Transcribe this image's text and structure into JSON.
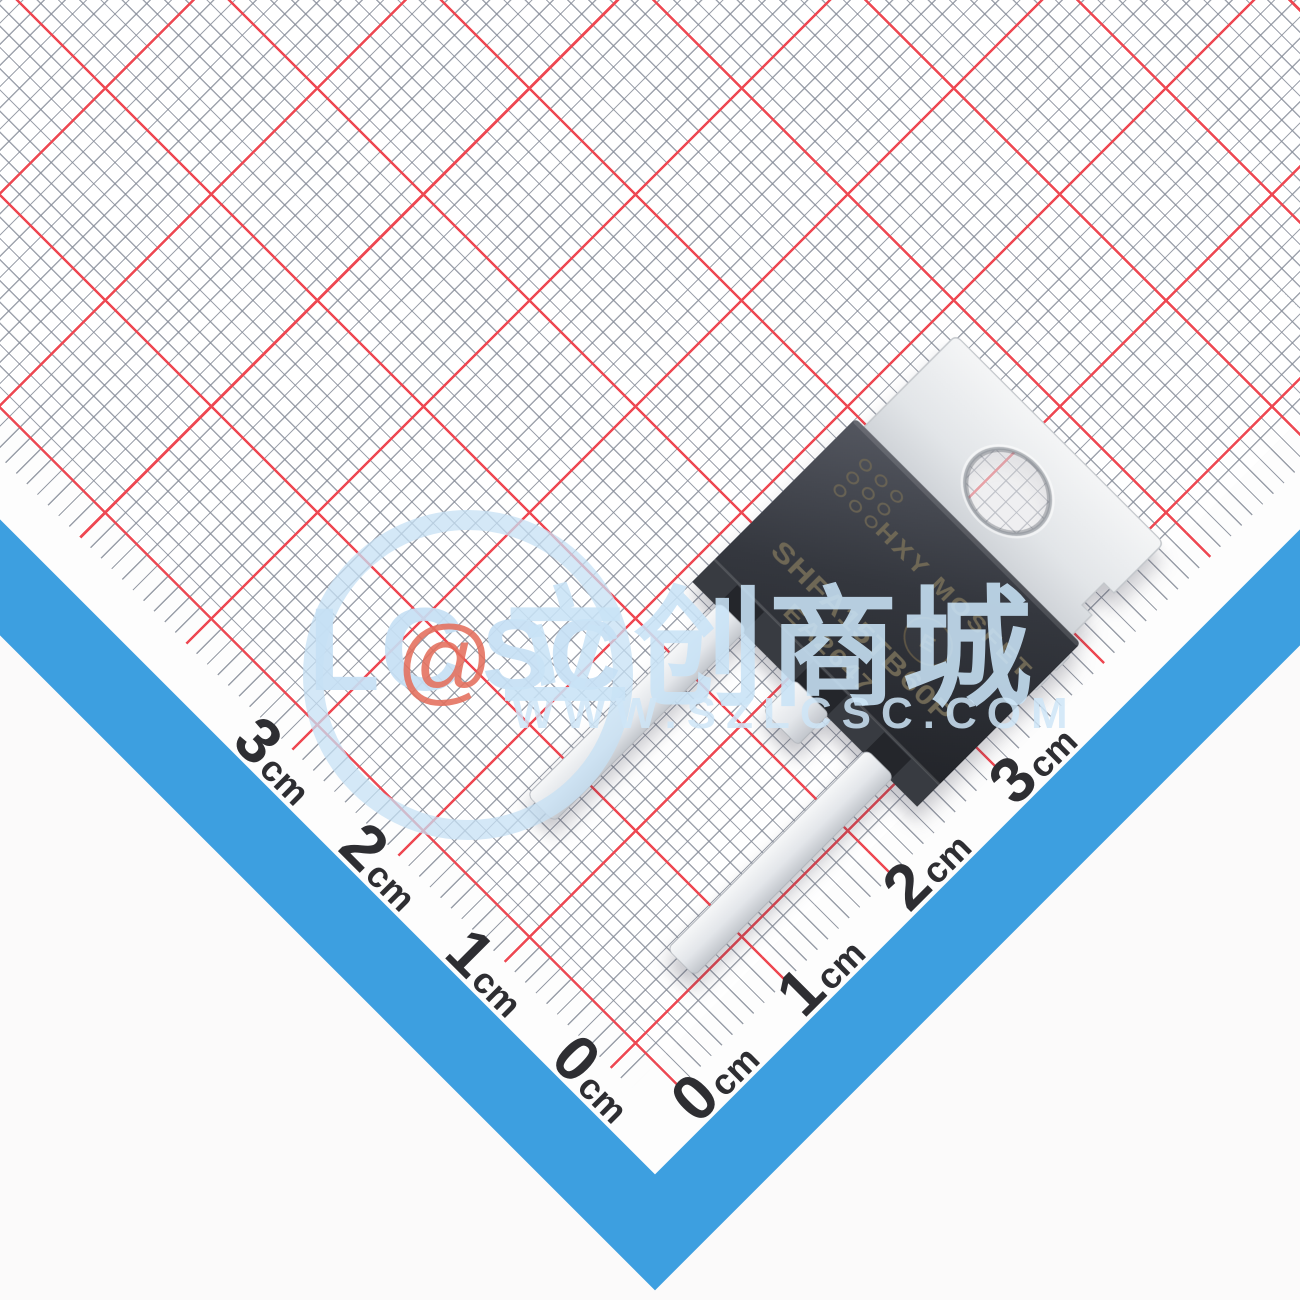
{
  "component": {
    "marking_line1": "HXY MOSFET",
    "marking_line2": "SHFA15TB60P",
    "marking_line3": "EA2647",
    "mold_mark": "E"
  },
  "watermark": {
    "logo_left": "LC",
    "logo_at": "@",
    "logo_right": "SC",
    "brand_cn": "立创商城",
    "url": "WWW.SZLCSC.COM"
  },
  "ruler": {
    "left_labels": [
      {
        "n": "3",
        "u": "cm"
      },
      {
        "n": "2",
        "u": "cm"
      },
      {
        "n": "1",
        "u": "cm"
      },
      {
        "n": "0",
        "u": "cm"
      }
    ],
    "right_labels": [
      {
        "n": "0",
        "u": "cm"
      },
      {
        "n": "1",
        "u": "cm"
      },
      {
        "n": "2",
        "u": "cm"
      },
      {
        "n": "3",
        "u": "cm"
      }
    ]
  },
  "colors": {
    "grid_red": "#ee4852",
    "grid_gray": "#9298a4",
    "border_blue": "#3d9fe0",
    "watermark_blue": "#c8e0f4",
    "watermark_red": "#e46e5c",
    "package_body": "#2b2d33",
    "lead_metal": "#e8eaee",
    "marking_text": "#6e6755"
  }
}
